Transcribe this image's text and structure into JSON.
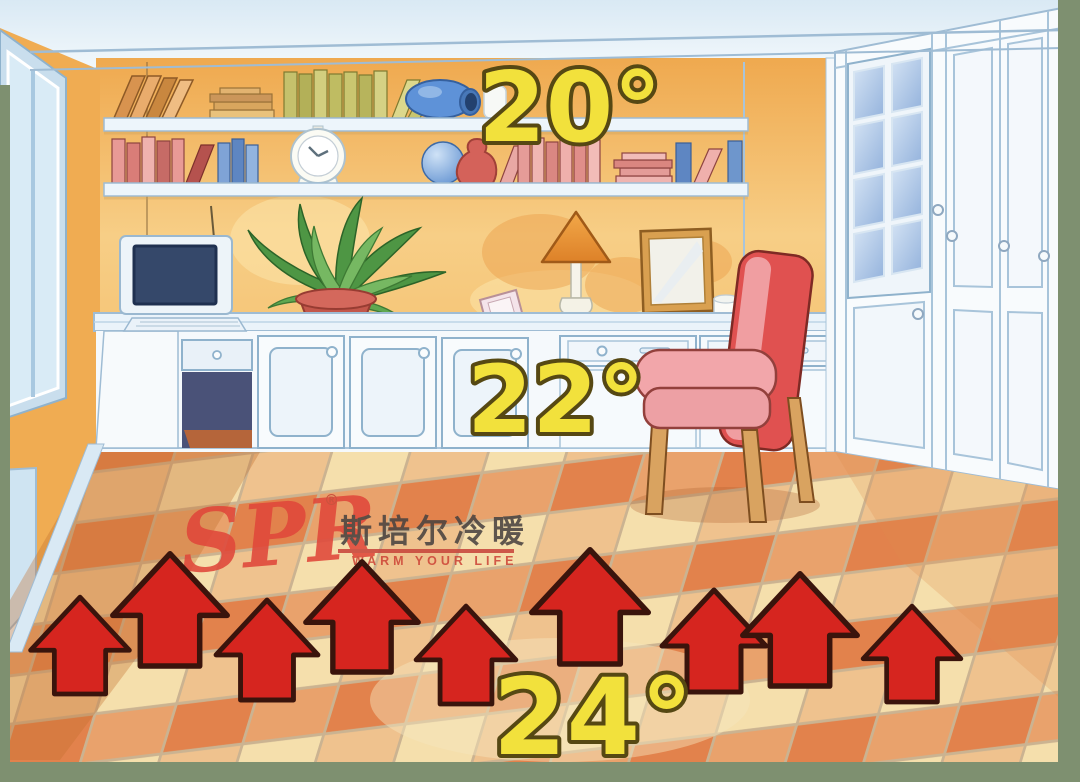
{
  "scene": {
    "type": "illustration",
    "subject": "Floor-heating temperature distribution inside a study room",
    "frame_color": "#7E9070"
  },
  "temperatures": {
    "ceiling_level": "20°",
    "seating_level": "22°",
    "floor_level": "24°",
    "label_fill": "#F2E13C",
    "label_outline": "#564813"
  },
  "brand": {
    "logo_text": "SPR",
    "registered_mark": "®",
    "chinese_name": "斯培尔冷暖",
    "slogan": "WARM YOUR LIFE",
    "logo_color": "#E0473A",
    "chinese_color": "#4A4340",
    "slogan_color": "#CE4638"
  },
  "heating_arrows": {
    "count": 9,
    "direction": "up",
    "fill": "#D6251F",
    "outline": "#3A140C"
  },
  "palette": {
    "wall": "#F2B35C",
    "cabinets": "#F8FBFD",
    "cabinet_lines": "#8FB2CC",
    "ceiling": "#E8F1F8",
    "floor_tiles": [
      "#F5DFAC",
      "#EFC28E",
      "#E9A26C",
      "#E2824C"
    ],
    "chair_back": "#E05150",
    "chair_seat": "#F2A6AA"
  }
}
